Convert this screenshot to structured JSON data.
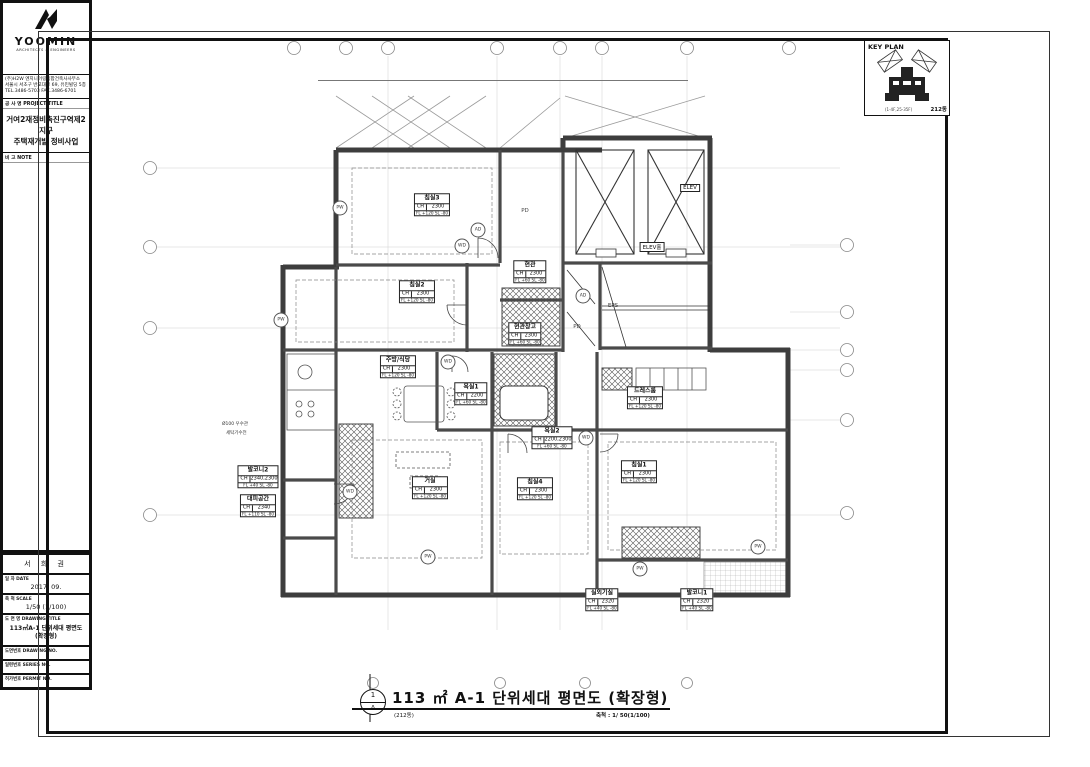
{
  "key_plan": {
    "title": "KEY PLAN",
    "building": "212동",
    "floors": "(1-4F,25-35F)"
  },
  "title_block": {
    "logo_name": "YOOMIN",
    "logo_sub": "ARCHITECTS & ENGINEERS",
    "firm_badge": "H2W",
    "firm_line1": "(주)H2W 엔지니어링종합건축사사무소",
    "firm_line2": "서울시 서초구 반포대로 69, 유민빌딩 5층",
    "firm_line3": "TEL.3486-5703  FAX.3486-6701",
    "project_label": "공 사 명  PROJECT TITLE",
    "project_name1": "거여2재정비촉진구역제2지구",
    "project_name2": "주택재개발 정비사업",
    "note_label": "비 고  NOTE",
    "notes": [
      "1.마감치수, 규격, 재질, 기구, 위생기기 주방가구, 천정 등은 모델하우스 설치시에 준한다.",
      "2.가든박스 및 경량의 위치 및 규격은 인테리어 도면 최종확정.",
      "3.다중공과 안내문구 표시된 부착",
      "4.발코니 바닥타일, 욕실마감은 구매시공에 의한 변경치수 적용.",
      "5.가스배관등 설비관련 시설물은 기계 및 전기도면 참조하여 시공할것.",
      "6.직배기 관통슬리브 위치는 해당설비 및 기계도면 참조하여 시공할것.",
      "7.설비, 전기관련 점검구는 설비도면, 전기도면참조하여 시공할 것."
    ],
    "revision_mark": "△",
    "revision_dots": "· ·",
    "staff_rows": [
      {
        "label": "책 임",
        "value": "제15116호"
      },
      {
        "label": "설 계",
        "value": ""
      },
      {
        "label": "작 성",
        "value": ""
      },
      {
        "label": "검 토",
        "value": ""
      },
      {
        "label": "승 인",
        "value": ""
      }
    ],
    "name_stamp": "서 희 권",
    "date_label": "일 자  DATE",
    "date_value": "2017. 09.",
    "scale_label": "축 척  SCALE",
    "scale_value": "1/50 (1/100)",
    "dwg_title_label": "도 면 명  DRAWING TITLE",
    "dwg_title": "113㎡A-1 단위세대 평면도 (확장형)",
    "dwg_no_label": "도면번호  DRAWING NO.",
    "dwg_no_boxes": [
      "A",
      "1",
      "-",
      "2",
      "1",
      "5",
      "0"
    ],
    "series_label": "일련번호  SERIES NO.",
    "series_boxes": [
      "",
      "",
      "-",
      "",
      "",
      "",
      ""
    ],
    "permit_label": "허가번호  PERMIT NO.",
    "permit_boxes": [
      "",
      "",
      "-",
      "",
      "",
      "",
      ""
    ]
  },
  "plan": {
    "rooms": [
      {
        "key": "bedroom3",
        "name": "침실3",
        "ch": "2300",
        "fl": "FL +120  SL -80"
      },
      {
        "key": "bedroom2",
        "name": "침실2",
        "ch": "2300",
        "fl": "FL +120  SL -80"
      },
      {
        "key": "entry",
        "name": "현관",
        "ch": "2300",
        "fl": "FL +60  SL -80"
      },
      {
        "key": "entry-storage",
        "name": "현관창고",
        "ch": "2300",
        "fl": "FL +60  SL -80"
      },
      {
        "key": "kitchen",
        "name": "주방/식당",
        "ch": "2300",
        "fl": "FL +120  SL -80"
      },
      {
        "key": "bath1",
        "name": "욕실1",
        "ch": "2200",
        "fl": "FL +60  SL -80"
      },
      {
        "key": "bath2",
        "name": "욕실2",
        "ch": "2200,2300",
        "fl": "FL +60  SL -80"
      },
      {
        "key": "living",
        "name": "거실",
        "ch": "2300",
        "fl": "FL +120  SL -80"
      },
      {
        "key": "bedroom4",
        "name": "침실4",
        "ch": "2300",
        "fl": "FL +120  SL -80"
      },
      {
        "key": "dressroom",
        "name": "드레스룸",
        "ch": "2300",
        "fl": "FL +120  SL -80"
      },
      {
        "key": "bedroom1",
        "name": "침실1",
        "ch": "2300",
        "fl": "FL +120  SL -80"
      },
      {
        "key": "balcony2",
        "name": "발코니2",
        "ch": "2340,2300",
        "fl": "FL +40  SL -80"
      },
      {
        "key": "shelter",
        "name": "대피공간",
        "ch": "2340",
        "fl": "FL +110  SL -80"
      },
      {
        "key": "acroom",
        "name": "실외기실",
        "ch": "2320",
        "fl": "FL +40  SL -80"
      },
      {
        "key": "balcony1",
        "name": "발코니1",
        "ch": "2320",
        "fl": "FL +40  SL -80"
      }
    ],
    "core": {
      "elev": "ELEV",
      "elev_hall": "ELEV홀",
      "eps": "EPS",
      "pd": "PD"
    },
    "tag_types": [
      "PW",
      "WD",
      "AD"
    ],
    "annotations": [
      "Ø100 우수관",
      "세탁기수전"
    ]
  },
  "dimensions": {
    "top": {
      "total": "14,240",
      "row": [
        [
          "1,250",
          1250
        ],
        [
          "1,300",
          1300
        ],
        [
          "4,420",
          4420
        ],
        [
          "2,320",
          2320
        ],
        [
          "1,725",
          1725
        ],
        [
          "3,345",
          3345
        ]
      ],
      "inner": [
        "4,100",
        "1,500",
        "3,160"
      ]
    },
    "bottom": {
      "total": "14,240",
      "row1": [
        [
          "515",
          515
        ],
        [
          "1,300",
          1300
        ],
        [
          "135",
          135
        ],
        [
          "755",
          755
        ],
        [
          "3,270",
          3270
        ],
        [
          "735",
          735
        ],
        [
          "1,025",
          1025
        ],
        [
          "1,170",
          1170
        ],
        [
          "1,025",
          1025
        ],
        [
          "95",
          95
        ],
        [
          "870",
          870
        ],
        [
          "630",
          630
        ],
        [
          "1,170",
          1170
        ],
        [
          "1,435",
          1435
        ]
      ],
      "row2": [
        [
          "",
          2150
        ],
        [
          "4,500",
          4500
        ],
        [
          "110",
          110
        ],
        [
          "3,000",
          3000
        ],
        [
          "110",
          110
        ],
        [
          "3,900",
          3900
        ],
        [
          "",
          470
        ]
      ],
      "row3": [
        [
          "2,150",
          2150
        ],
        [
          "4,750",
          4750
        ],
        [
          "3,220",
          3220
        ],
        [
          "4,120",
          4120
        ]
      ]
    },
    "left": {
      "total": "15,310",
      "col1": [
        [
          "3,170",
          3170
        ],
        [
          "3,170",
          3170
        ],
        [
          "7,470",
          7470
        ],
        [
          "1,500",
          1500
        ]
      ],
      "col2": [
        [
          "1,025",
          1025
        ],
        [
          "1,170",
          1170
        ],
        [
          "975",
          975
        ],
        [
          "975",
          975
        ],
        [
          "1,170",
          1170
        ],
        [
          "1,025",
          1025
        ],
        [
          "1,570",
          1570
        ],
        [
          "1,170",
          1170
        ],
        [
          "1,730",
          1730
        ],
        [
          "1,170",
          1170
        ],
        [
          "1,620",
          1620
        ]
      ]
    },
    "right": {
      "col1": [
        [
          "2,500",
          2500
        ],
        [
          "1,030",
          1030
        ],
        [
          "2,400",
          2400
        ],
        [
          "1,465",
          1465
        ],
        [
          "2,380",
          2380
        ],
        [
          "3,500",
          3500
        ],
        [
          "1,500",
          1500
        ]
      ],
      "mid": [
        "3,665",
        "2,780",
        "4,050"
      ],
      "outer": [
        "7,680",
        "8,270"
      ]
    }
  },
  "footer": {
    "detail_no": "1",
    "section": "A",
    "title": "113 ㎡ A-1 단위세대 평면도 (확장형)",
    "building": "(212동)",
    "scale": "축척 : 1/ 50(1/100)"
  }
}
